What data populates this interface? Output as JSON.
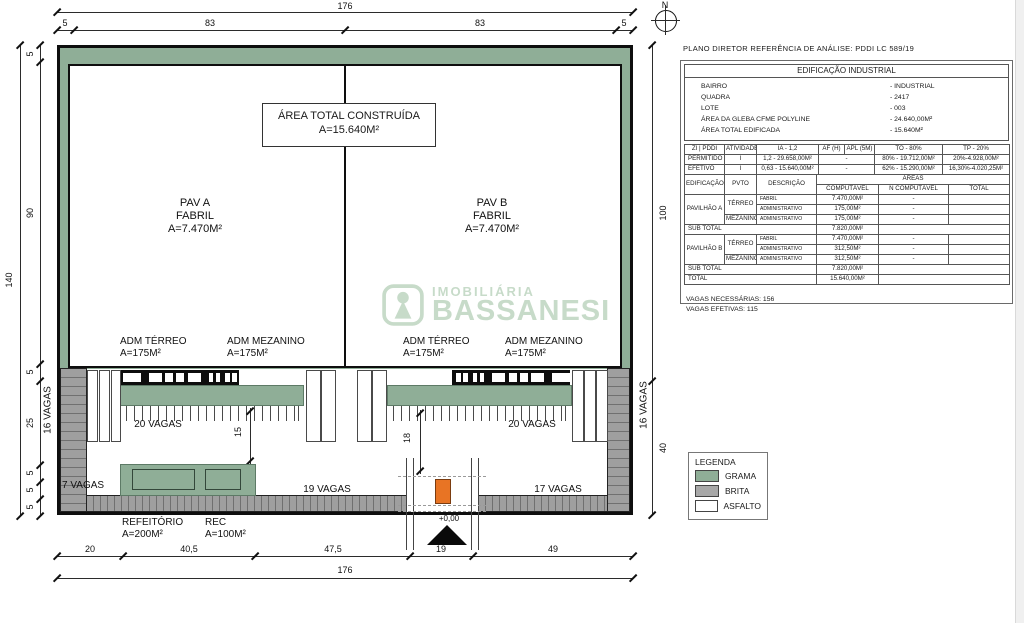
{
  "north": {
    "label": "N"
  },
  "dims": {
    "top_total": "176",
    "top_segments": [
      "5",
      "83",
      "83",
      "5"
    ],
    "left_total": "140",
    "left_segments": [
      "5",
      "90",
      "5",
      "25",
      "5",
      "5",
      "5"
    ],
    "right_segments": [
      "100",
      "40"
    ],
    "bottom_segments": [
      "20",
      "40,5",
      "47,5",
      "19",
      "49"
    ],
    "bottom_total": "176",
    "inner_left": "15",
    "inner_right": "18"
  },
  "building": {
    "total_box": {
      "line1": "ÁREA TOTAL CONSTRUÍDA",
      "line2": "A=15.640M²"
    },
    "pav_a": {
      "line1": "PAV A",
      "line2": "FABRIL",
      "line3": "A=7.470M²"
    },
    "pav_b": {
      "line1": "PAV B",
      "line2": "FABRIL",
      "line3": "A=7.470M²"
    },
    "adm": [
      {
        "line1": "ADM TÉRREO",
        "line2": "A=175M²"
      },
      {
        "line1": "ADM MEZANINO",
        "line2": "A=175M²"
      },
      {
        "line1": "ADM TÉRREO",
        "line2": "A=175M²"
      },
      {
        "line1": "ADM MEZANINO",
        "line2": "A=175M²"
      }
    ]
  },
  "site": {
    "vagas_left_strip": "16 VAGAS",
    "vagas_right_strip": "16 VAGAS",
    "vagas_lot_a": "20 VAGAS",
    "vagas_lot_b": "20 VAGAS",
    "vagas_bottom_left": "7 VAGAS",
    "vagas_bottom_center": "19 VAGAS",
    "vagas_bottom_right": "17 VAGAS",
    "refeitorio": {
      "line1": "REFEITÓRIO",
      "line2": "A=200M²"
    },
    "rec": {
      "line1": "REC",
      "line2": "A=100M²"
    },
    "entrance_level": "+0,00"
  },
  "watermark": {
    "top": "IMOBILIÁRIA",
    "bottom": "BASSANESI"
  },
  "panel": {
    "title": "PLANO DIRETOR REFERÊNCIA DE ANÁLISE: PDDI LC 589/19",
    "building_table": {
      "header": "EDIFICAÇÃO INDUSTRIAL",
      "rows": [
        {
          "label": "BAIRRO",
          "value": "- INDUSTRIAL"
        },
        {
          "label": "QUADRA",
          "value": "- 2417"
        },
        {
          "label": "LOTE",
          "value": "- 003"
        },
        {
          "label": "ÁREA DA GLEBA CFME POLYLINE",
          "value": "- 24.640,00M²"
        },
        {
          "label": "ÁREA TOTAL EDIFICADA",
          "value": "- 15.640M²"
        }
      ]
    },
    "zoning_table": {
      "headers": [
        "ZI | PDDI",
        "ATIVIDADE",
        "IA - 1,2",
        "AF (H)",
        "APL (5M)",
        "TO - 80%",
        "TP - 20%"
      ],
      "permitido": {
        "c0": "PERMITIDO",
        "c1": "I",
        "c2": "1,2 - 29.658,00M²",
        "c3": "-",
        "c4": "80% - 19.712,00M²",
        "c5": "20%-4.928,00M²"
      },
      "efetivo": {
        "c0": "EFETIVO",
        "c1": "I",
        "c2": "0,63 - 15.640,00M²",
        "c3": "-",
        "c4": "62% - 15.290,00M²",
        "c5": "16,30%-4.020,25M²"
      }
    },
    "areas_table": {
      "headers": {
        "edificacao": "EDIFICAÇÃO",
        "pvto": "PVTO",
        "descricao": "DESCRIÇÃO",
        "areas": "ÁREAS",
        "computavel": "COMPUTÁVEL",
        "n_computavel": "Ñ COMPUTÁVEL",
        "total": "TOTAL"
      },
      "pav_a": {
        "name": "PAVILHÃO A",
        "terreo": "TÉRREO",
        "mezanino": "MEZANINO",
        "rows": [
          {
            "desc": "FABRIL",
            "comp": "7.470,00M²",
            "ncomp": "-"
          },
          {
            "desc": "ADMINISTRATIVO",
            "comp": "175,00M²",
            "ncomp": "-"
          },
          {
            "desc": "ADMINISTRATIVO",
            "comp": "175,00M²",
            "ncomp": "-"
          }
        ],
        "subtotal_label": "SUB TOTAL",
        "subtotal": "7.820,00M²"
      },
      "pav_b": {
        "name": "PAVILHÃO B",
        "terreo": "TÉRREO",
        "mezanino": "MEZANINO",
        "rows": [
          {
            "desc": "FABRIL",
            "comp": "7.470,00M²",
            "ncomp": "-"
          },
          {
            "desc": "ADMINISTRATIVO",
            "comp": "312,50M²",
            "ncomp": "-"
          },
          {
            "desc": "ADMINISTRATIVO",
            "comp": "312,50M²",
            "ncomp": "-"
          }
        ],
        "subtotal_label": "SUB TOTAL",
        "subtotal": "7.820,00M²"
      },
      "total_label": "TOTAL",
      "total": "15.640,00M²"
    },
    "vagas_necessarias": "VAGAS NECESSÁRIAS: 156",
    "vagas_efetivas": "VAGAS EFETIVAS: 115"
  },
  "legend": {
    "title": "LEGENDA",
    "items": [
      {
        "label": "GRAMA",
        "color": "#8fae97"
      },
      {
        "label": "BRITA",
        "color": "#a8a8a8"
      },
      {
        "label": "ASFALTO",
        "color": "#ffffff"
      }
    ]
  },
  "colors": {
    "grass": "#8fae97",
    "gravel": "#9f9f9f",
    "asphalt": "#ffffff",
    "orange": "#e87424",
    "watermark": "#c7dbc9"
  }
}
